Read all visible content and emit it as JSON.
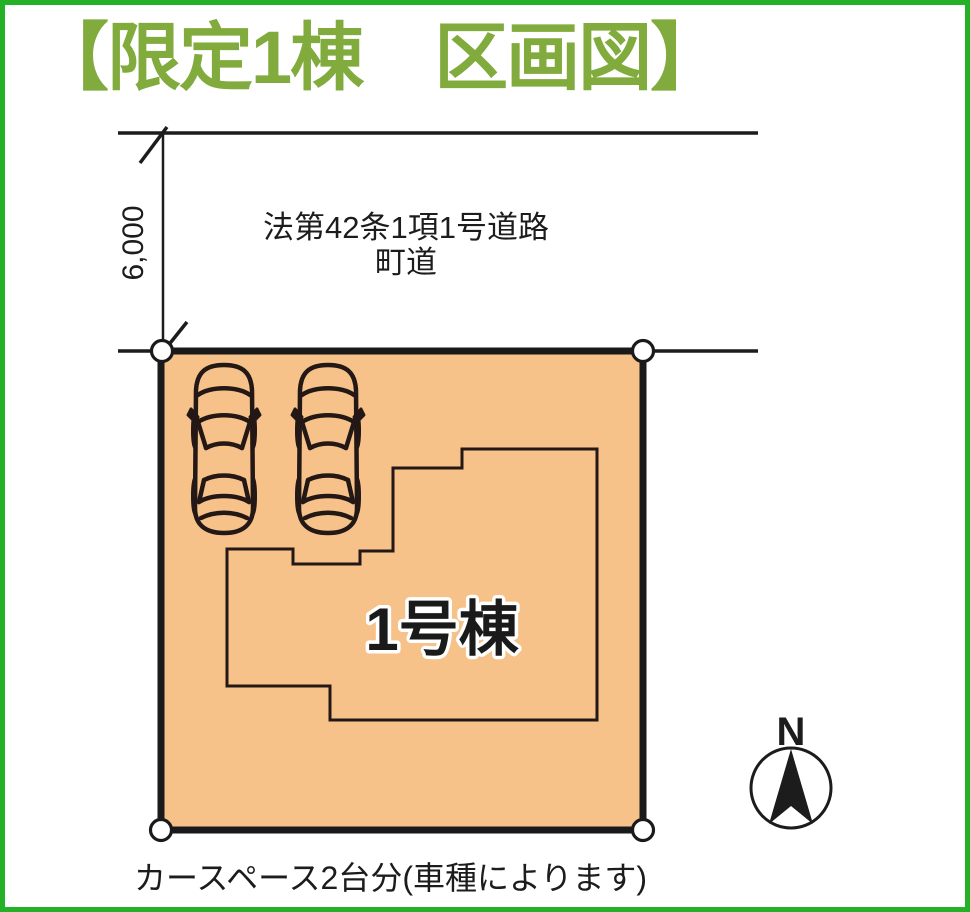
{
  "title": {
    "text": "【限定1棟　区画図】",
    "color": "#81AB3D"
  },
  "road": {
    "type": "法第42条1項1号道路",
    "name": "町道"
  },
  "dimension": {
    "value": "6,000"
  },
  "lot": {
    "building_label": "1号棟",
    "fill_color": "#F6C289",
    "boundary_marker_count": 4
  },
  "cars": {
    "count": 2
  },
  "caption": {
    "text": "カースペース2台分(車種によります)"
  },
  "compass": {
    "north_label": "N"
  },
  "colors": {
    "frame_border": "#25B125",
    "line": "#1C1C1C",
    "building_outline": "#231815"
  }
}
